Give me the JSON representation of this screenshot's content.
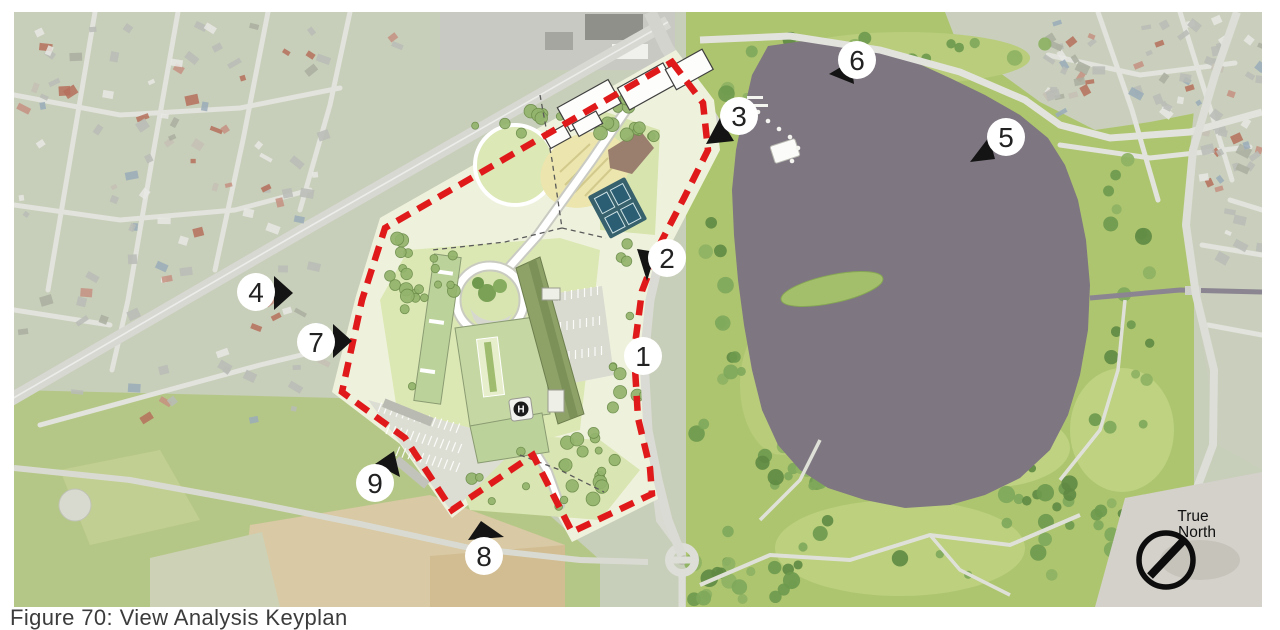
{
  "figure": {
    "caption": "Figure 70: View Analysis Keyplan"
  },
  "compass": {
    "line1": "True",
    "line2": "North"
  },
  "site_plan": {
    "helipad_label": "H"
  },
  "site_boundary": {
    "color": "#e01a1a",
    "style": "dashed"
  },
  "marker_style": {
    "circle_fill": "#ffffff",
    "number_color": "#222222",
    "arrow_color": "#141414"
  },
  "view_markers": [
    {
      "label": "1",
      "x": 643,
      "y": 356,
      "arrow": null
    },
    {
      "label": "2",
      "x": 667,
      "y": 258,
      "arrow": [
        [
          637,
          249
        ],
        [
          656,
          252
        ],
        [
          647,
          281
        ]
      ]
    },
    {
      "label": "3",
      "x": 739,
      "y": 116,
      "arrow": [
        [
          720,
          118
        ],
        [
          734,
          141
        ],
        [
          706,
          144
        ]
      ]
    },
    {
      "label": "4",
      "x": 256,
      "y": 292,
      "arrow": [
        [
          274,
          276
        ],
        [
          274,
          310
        ],
        [
          293,
          293
        ]
      ]
    },
    {
      "label": "5",
      "x": 1006,
      "y": 137,
      "arrow": [
        [
          989,
          137
        ],
        [
          995,
          159
        ],
        [
          970,
          162
        ]
      ]
    },
    {
      "label": "6",
      "x": 857,
      "y": 60,
      "arrow": [
        [
          851,
          61
        ],
        [
          854,
          84
        ],
        [
          829,
          74
        ]
      ]
    },
    {
      "label": "7",
      "x": 316,
      "y": 342,
      "arrow": [
        [
          333,
          324
        ],
        [
          333,
          358
        ],
        [
          352,
          341
        ]
      ]
    },
    {
      "label": "8",
      "x": 484,
      "y": 556,
      "arrow": [
        [
          481,
          521
        ],
        [
          468,
          540
        ],
        [
          504,
          537
        ]
      ]
    },
    {
      "label": "9",
      "x": 375,
      "y": 483,
      "arrow": [
        [
          394,
          451
        ],
        [
          375,
          464
        ],
        [
          400,
          477
        ]
      ]
    }
  ]
}
